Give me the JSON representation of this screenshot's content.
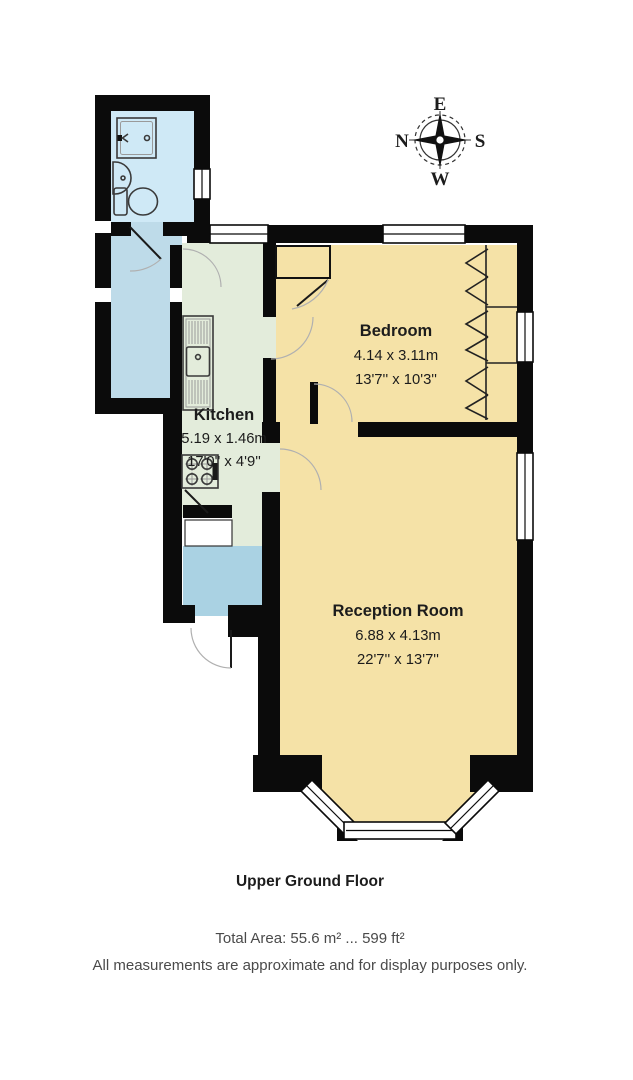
{
  "compass": {
    "north": "N",
    "east": "E",
    "south": "S",
    "west": "W"
  },
  "rooms": {
    "kitchen": {
      "name": "Kitchen",
      "size_metric": "5.19 x 1.46m",
      "size_imperial": "17'0'' x 4'9''"
    },
    "bedroom": {
      "name": "Bedroom",
      "size_metric": "4.14 x 3.11m",
      "size_imperial": "13'7'' x 10'3''"
    },
    "reception": {
      "name": "Reception Room",
      "size_metric": "6.88 x 4.13m",
      "size_imperial": "22'7'' x 13'7''"
    }
  },
  "footer": {
    "floor_label": "Upper Ground Floor",
    "total_area": "Total Area: 55.6 m² ... 599 ft²",
    "disclaimer": "All measurements are approximate and for display purposes only."
  },
  "colors": {
    "wall": "#0b0b0b",
    "room_cream": "#f5e2a7",
    "kitchen_green": "#e3ecdb",
    "bathroom_blue": "#cfe9f6",
    "corridor_blue": "#bedbe9",
    "hall_blue": "#aad2e3",
    "window_white": "#ffffff",
    "text_dark": "#1c1c1c",
    "text_grey": "#4a4a4a"
  }
}
